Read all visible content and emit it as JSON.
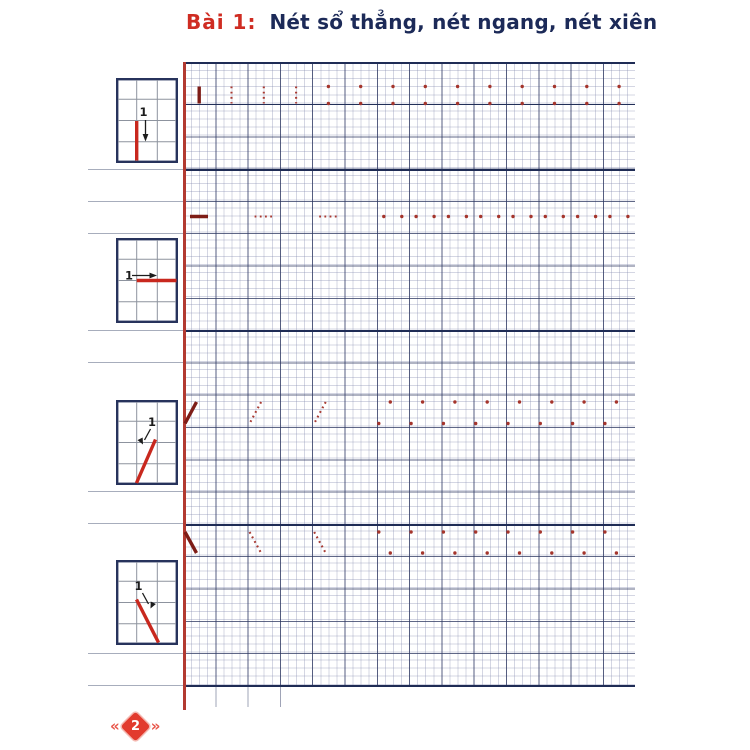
{
  "header": {
    "lesson_label": "Bài 1:",
    "title": "Nét sổ thẳng, nét ngang, nét xiên"
  },
  "guide_boxes": [
    {
      "stroke": "vertical",
      "step": "1"
    },
    {
      "stroke": "horizontal",
      "step": "1"
    },
    {
      "stroke": "slant-left",
      "step": "1"
    },
    {
      "stroke": "slant-right",
      "step": "1"
    }
  ],
  "practice": {
    "rows": [
      {
        "stroke": "vertical",
        "pattern": [
          "solid",
          "dotted",
          "dotted",
          "dotted",
          "dots",
          "dots",
          "dots",
          "dots",
          "dots",
          "dots",
          "dots",
          "dots",
          "dots",
          "dots"
        ]
      },
      {
        "stroke": "horizontal",
        "pattern": [
          "solid",
          "none",
          "dotted",
          "none",
          "dotted",
          "none",
          "dots",
          "dots",
          "dots",
          "dots",
          "dots",
          "dots",
          "dots",
          "dots"
        ]
      },
      {
        "stroke": "slant-left",
        "pattern": [
          "solid",
          "none",
          "dotted",
          "none",
          "dotted",
          "none",
          "dots",
          "dots",
          "dots",
          "dots",
          "dots",
          "dots",
          "dots",
          "dots"
        ]
      },
      {
        "stroke": "slant-right",
        "pattern": [
          "solid",
          "none",
          "dotted",
          "none",
          "dotted",
          "none",
          "dots",
          "dots",
          "dots",
          "dots",
          "dots",
          "dots",
          "dots",
          "dots"
        ]
      }
    ]
  },
  "footer": {
    "page_number": "2"
  },
  "colors": {
    "accent_red": "#cf2c22",
    "title_navy": "#1c2a58",
    "grid_navy": "#2b355f",
    "margin_red": "#b23a31",
    "guide_red": "#c8281e",
    "stroke_solid": "#7e1d17",
    "stroke_dotted": "#a83a32",
    "stroke_dot": "#a5352c",
    "diamond_red": "#e23b2e",
    "chevron_red": "#e8564a",
    "box_border": "#27335c",
    "box_grid": "#8d939e",
    "label_dark": "#1c1c1c"
  }
}
